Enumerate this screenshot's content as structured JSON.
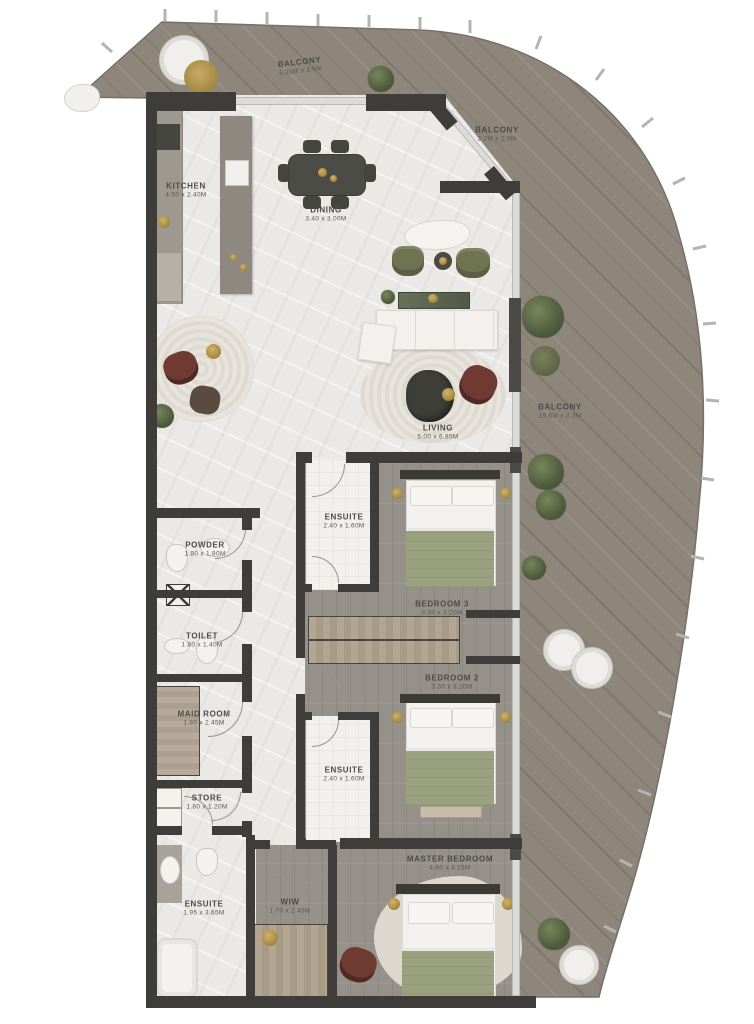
{
  "title": "Apartment Floor Plan",
  "rooms": {
    "balcony_top": {
      "name": "BALCONY",
      "dims": "6.26M x 1.5M"
    },
    "balcony_upper_right": {
      "name": "BALCONY",
      "dims": "2.2M x 2.0M"
    },
    "balcony_right": {
      "name": "BALCONY",
      "dims": "19.6M x 2.3M"
    },
    "kitchen": {
      "name": "KITCHEN",
      "dims": "4.50 x 2.40M"
    },
    "dining": {
      "name": "DINING",
      "dims": "3.40 x 3.00M"
    },
    "living": {
      "name": "LIVING",
      "dims": "5.00 x 6.85M"
    },
    "powder": {
      "name": "POWDER",
      "dims": "1.80 x 1.80M"
    },
    "toilet": {
      "name": "TOILET",
      "dims": "1.80 x 1.40M"
    },
    "maid_room": {
      "name": "MAID ROOM",
      "dims": "1.80 x 2.45M"
    },
    "store": {
      "name": "STORE",
      "dims": "1.80 x 1.20M"
    },
    "ensuite_bed3": {
      "name": "ENSUITE",
      "dims": "2.40 x 1.60M"
    },
    "bedroom3": {
      "name": "BEDROOM 3",
      "dims": "3.30 x 3.20M"
    },
    "bedroom2": {
      "name": "BEDROOM 2",
      "dims": "3.30 x 3.20M"
    },
    "ensuite_bed2": {
      "name": "ENSUITE",
      "dims": "2.40 x 1.60M"
    },
    "master_bedroom": {
      "name": "MASTER BEDROOM",
      "dims": "4.60 x 4.15M"
    },
    "ensuite_master": {
      "name": "ENSUITE",
      "dims": "1.95 x 3.65M"
    },
    "wiw": {
      "name": "WIW",
      "dims": "1.70 x 2.45M"
    }
  },
  "colors": {
    "wall": "#3e3d3a",
    "deck_wood": "#8e857b",
    "indoor_marble": "#ebe9e6",
    "bedroom_wood": "#95908a",
    "olive_green": "#6e7452",
    "maroon": "#6f3a31",
    "gold": "#b08d3e",
    "label_text": "#4c4b47"
  }
}
